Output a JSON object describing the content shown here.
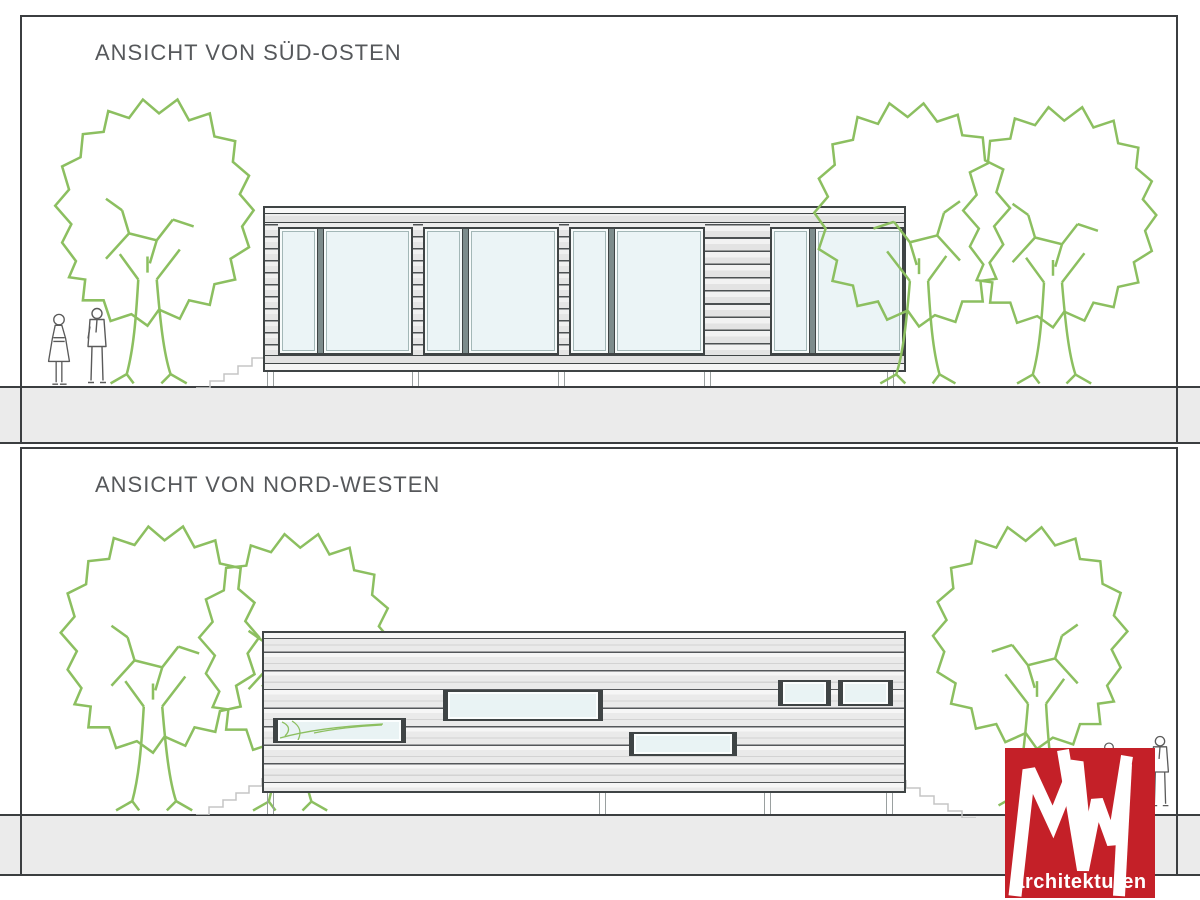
{
  "document": {
    "kind": "architectural elevation drawing",
    "sheet_background": "#ffffff"
  },
  "panels": [
    {
      "title": "ANSICHT VON SÜD-OSTEN"
    },
    {
      "title": "ANSICHT VON NORD-WESTEN"
    }
  ],
  "logo": {
    "monogram": "MW",
    "label": "architekturen",
    "background": "#c42028",
    "foreground": "#ffffff"
  },
  "colors": {
    "line_dark": "#3b3e40",
    "facade_gray": "#e9e9e9",
    "ground_gray": "#ebebeb",
    "glass_blue": "#eaf3f5",
    "tree_green": "#8cbf60",
    "stair_gray": "#c5c5c5",
    "figure_gray": "#5a5a5a"
  }
}
